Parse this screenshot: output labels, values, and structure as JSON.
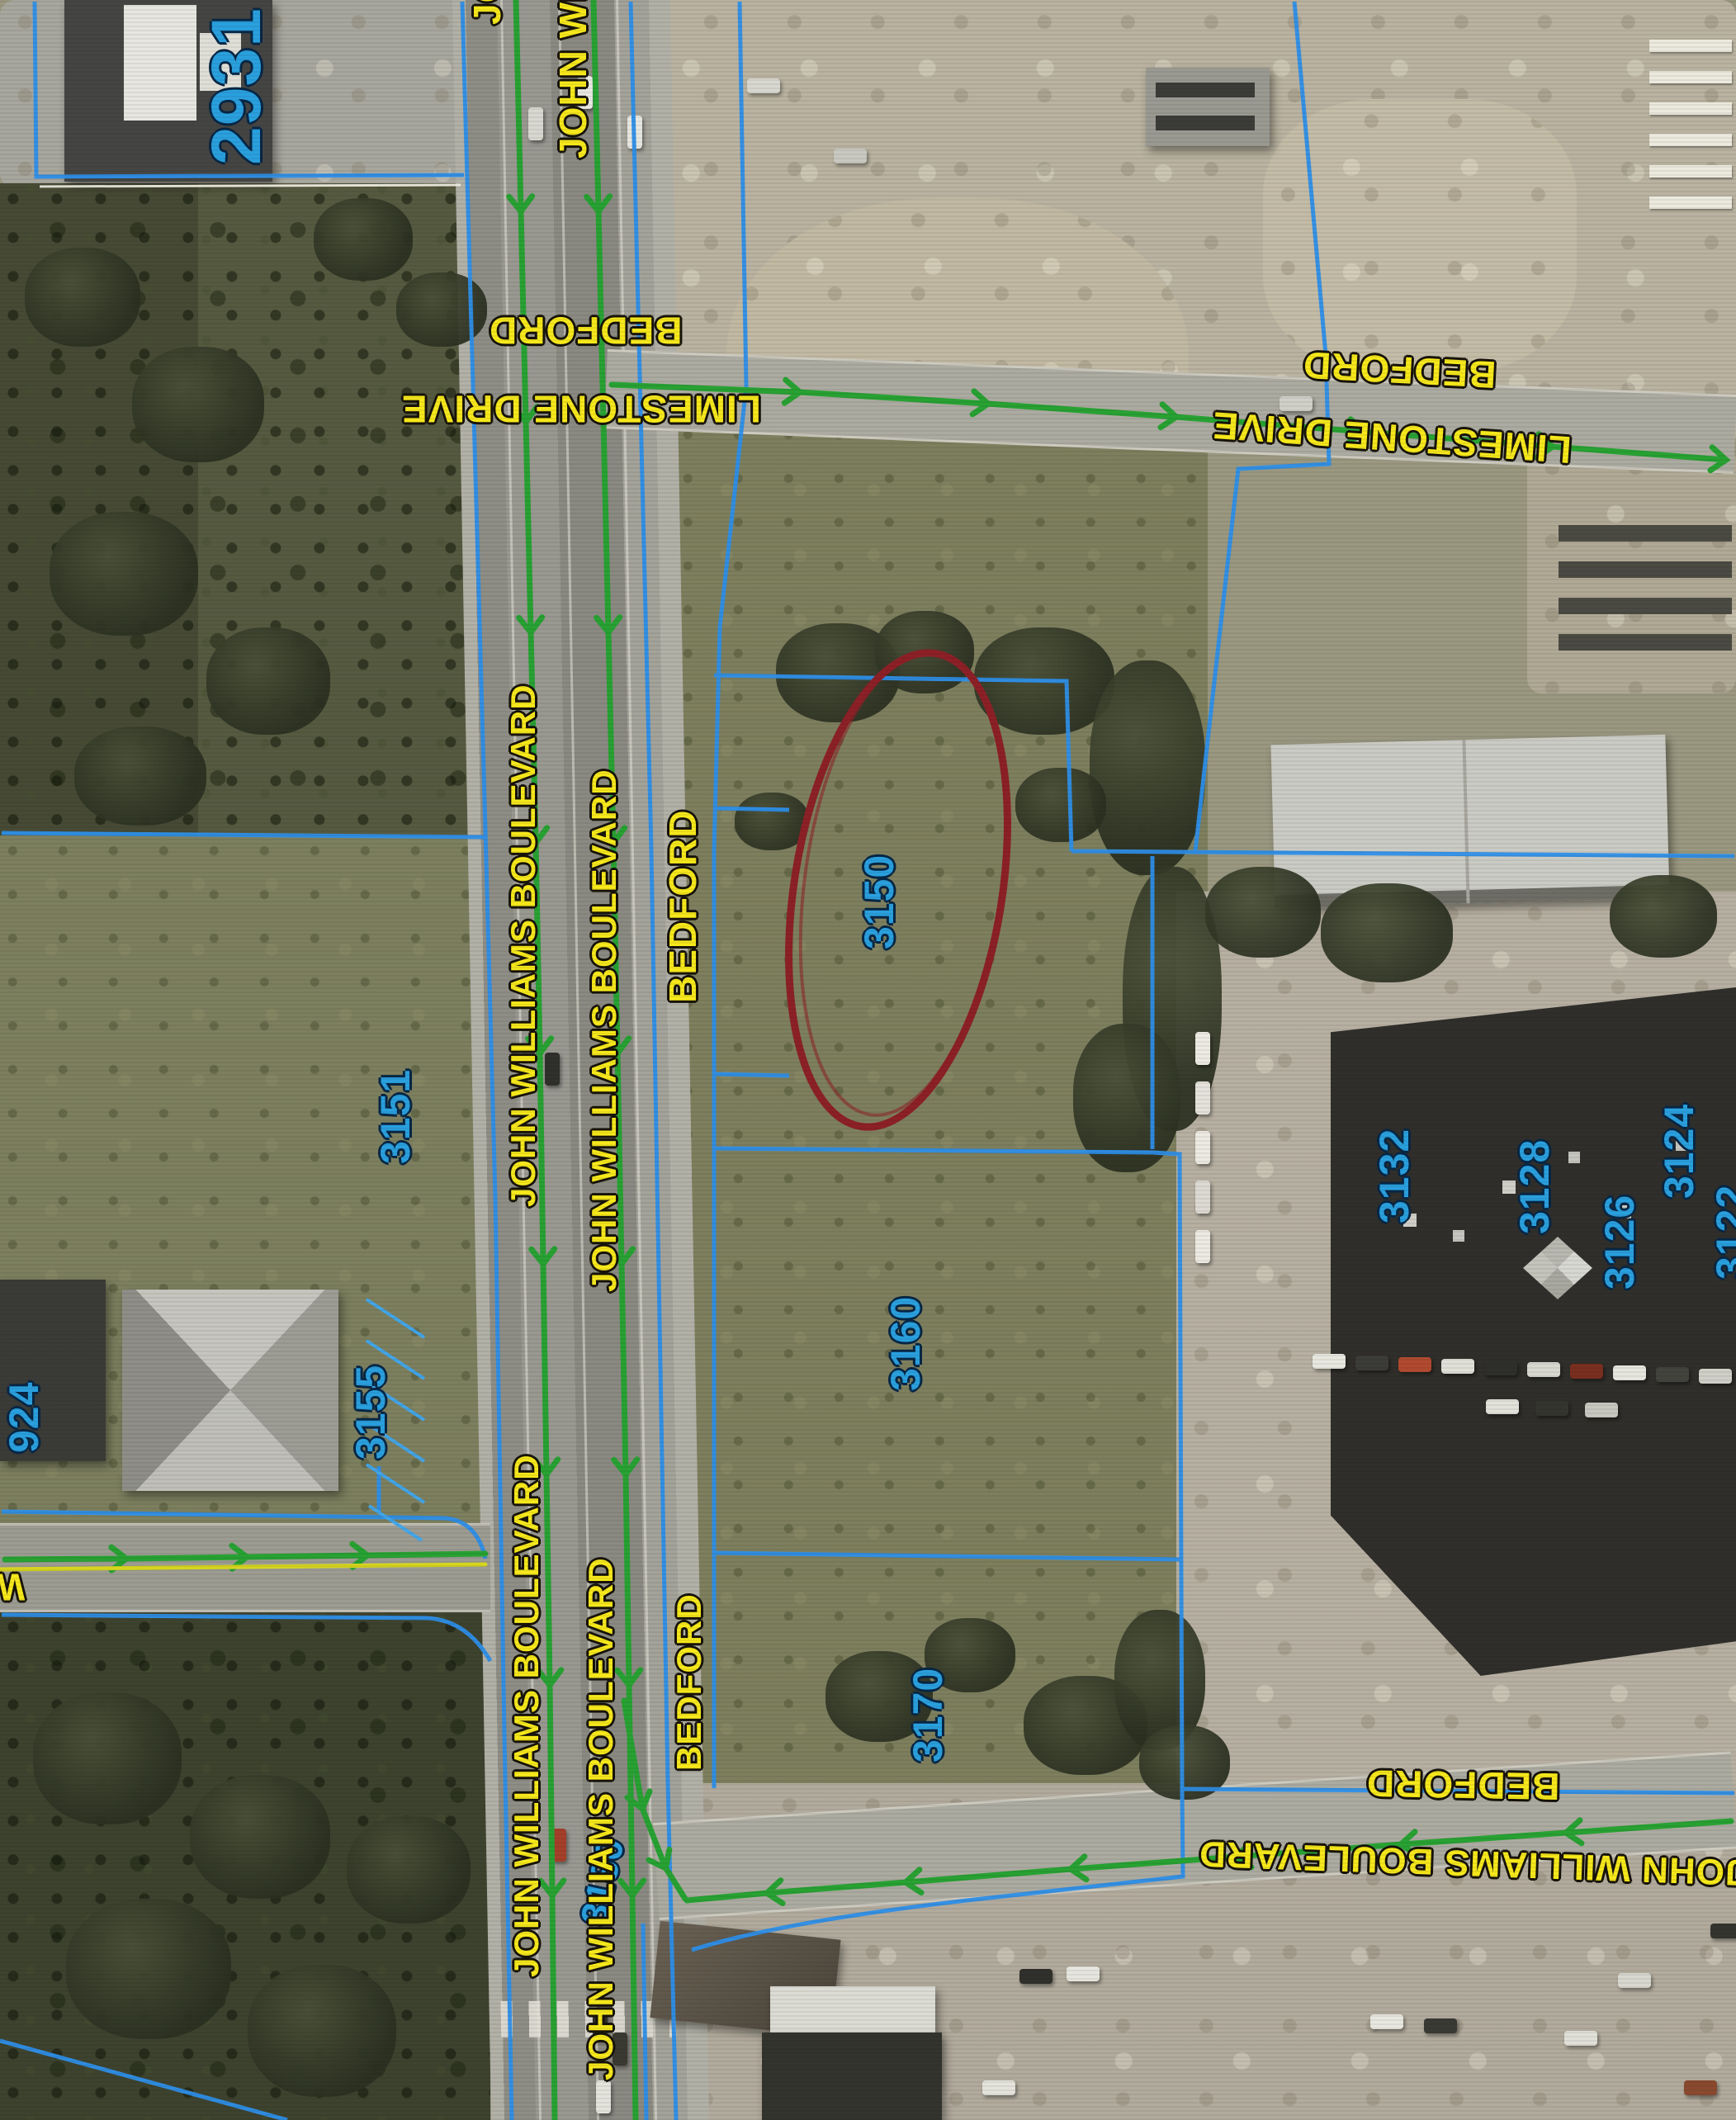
{
  "map": {
    "streets": {
      "john_williams": "JOHN WILLIAMS BOULEVARD",
      "bedford": "BEDFORD",
      "limestone": "LIMESTONE DRIVE",
      "wi_partial": "WI"
    },
    "parcels": {
      "p2931": "2931",
      "p3151": "3151",
      "p924": "924",
      "p3155": "3155",
      "p3150": "3150",
      "p3160": "3160",
      "p3170": "3170",
      "p3180": "3180",
      "p3132": "3132",
      "p3128": "3128",
      "p3126": "3126",
      "p3124": "3124",
      "p3122": "3122"
    },
    "annotation": {
      "highlighted_parcel": "3150"
    },
    "colors": {
      "street_label": "#f6e81c",
      "parcel_number": "#2aa0de",
      "parcel_line": "#2e8fe8",
      "centerline_green": "#28a233",
      "centerline_yellow": "#d6d51f",
      "highlight_red": "#8c2127"
    }
  }
}
